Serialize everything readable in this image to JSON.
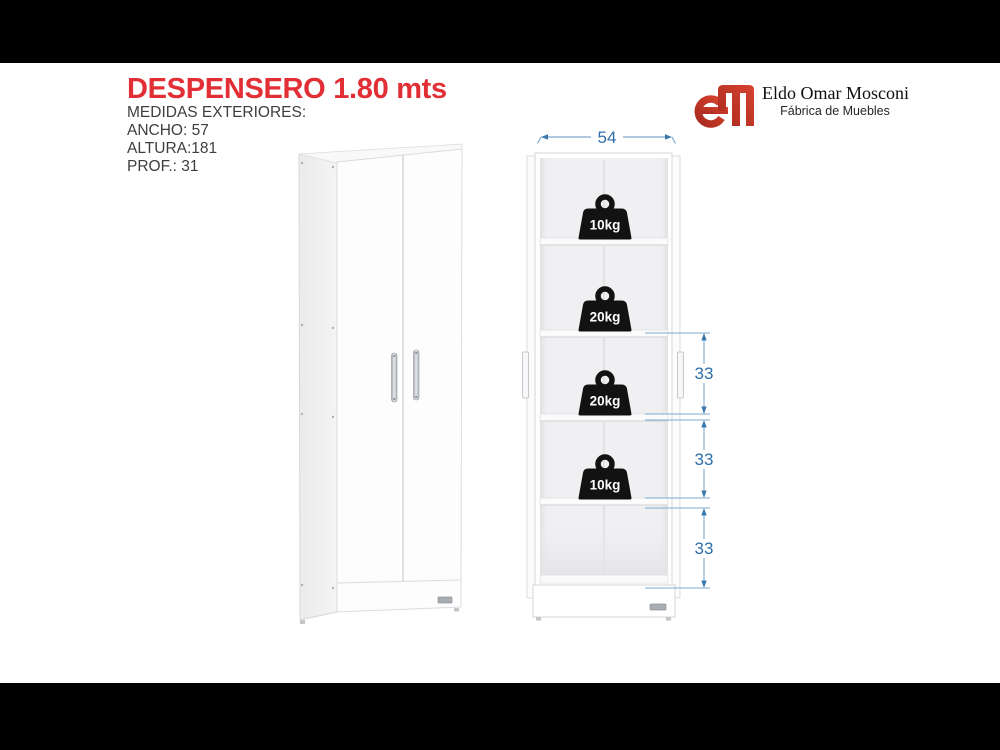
{
  "page": {
    "title": "DESPENSERO 1.80 mts",
    "measures_heading": "MEDIDAS EXTERIORES:",
    "measures": [
      "ANCHO: 57",
      "ALTURA:181",
      "PROF.: 31"
    ]
  },
  "brand": {
    "name": "Eldo Omar Mosconi",
    "tagline": "Fábrica de Muebles",
    "logo_monogram": "EM",
    "logo_color": "#c23a2a"
  },
  "diagram": {
    "width_label": "54",
    "shelf_height_labels": [
      "33",
      "33",
      "33"
    ],
    "shelf_capacities": [
      "10kg",
      "20kg",
      "20kg",
      "10kg"
    ],
    "dimension_color": "#2e6fa8"
  },
  "colors": {
    "title_red": "#e12f35",
    "body_text_gray": "#3e3e3e",
    "letterbox_black": "#000000",
    "cabinet_white": "#fdfdfe"
  }
}
